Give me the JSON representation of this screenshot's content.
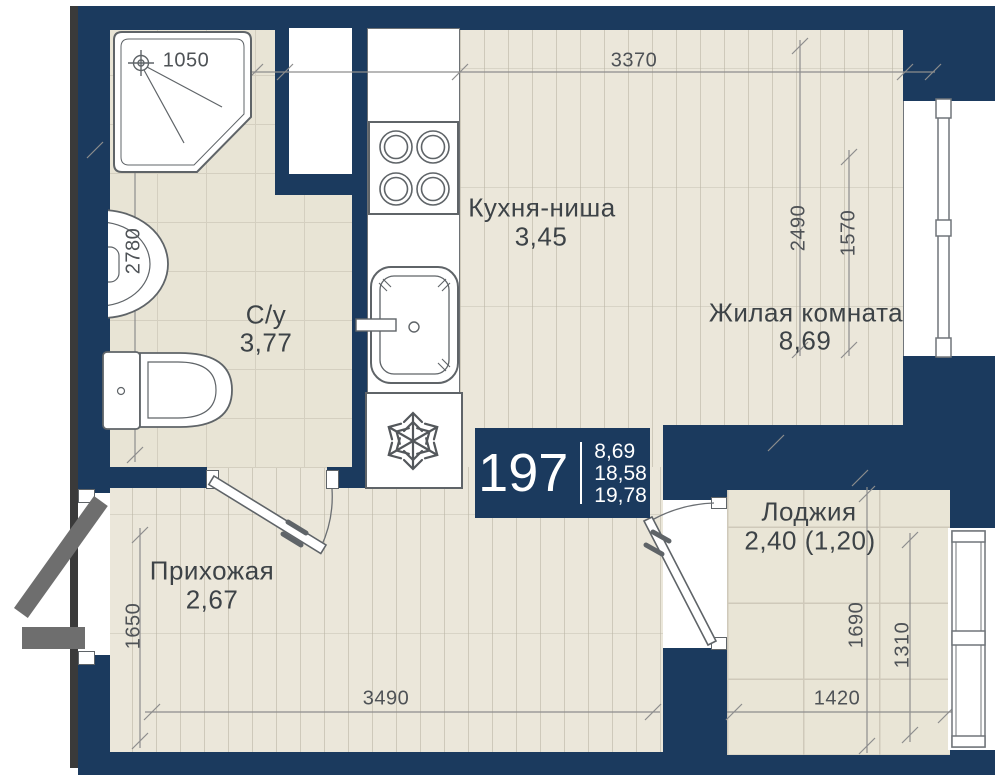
{
  "badge": {
    "unit_number": "197",
    "areas": [
      "8,69",
      "18,58",
      "19,78"
    ]
  },
  "rooms": {
    "kitchen": {
      "name": "Кухня-ниша",
      "area": "3,45"
    },
    "living": {
      "name": "Жилая комната",
      "area": "8,69"
    },
    "bathroom": {
      "name": "С/у",
      "area": "3,77"
    },
    "hallway": {
      "name": "Прихожая",
      "area": "2,67"
    },
    "loggia": {
      "name": "Лоджия",
      "area": "2,40 (1,20)"
    }
  },
  "dimensions": {
    "shower_width": "1050",
    "main_width_top": "3370",
    "living_depth": "2490",
    "living_window_height": "1570",
    "bathroom_depth": "2780",
    "hallway_depth": "1650",
    "hallway_width": "3490",
    "loggia_depth": "1690",
    "loggia_window_width": "1310",
    "loggia_width": "1420"
  },
  "colors": {
    "wall": "#1b3a5e",
    "wood_floor": "#ebe7da",
    "tile_floor": "#e8e4d5",
    "fixture_outline": "#5f6468",
    "dimension_line": "#8d8d8d",
    "entry_door": "#6e6e6e",
    "label_text": "#3d4347",
    "badge_background": "#1b3a5e",
    "badge_text": "#ffffff"
  },
  "icons": {
    "snowflake": "fridge-snowflake-icon",
    "shower_head": "shower-head-icon"
  }
}
